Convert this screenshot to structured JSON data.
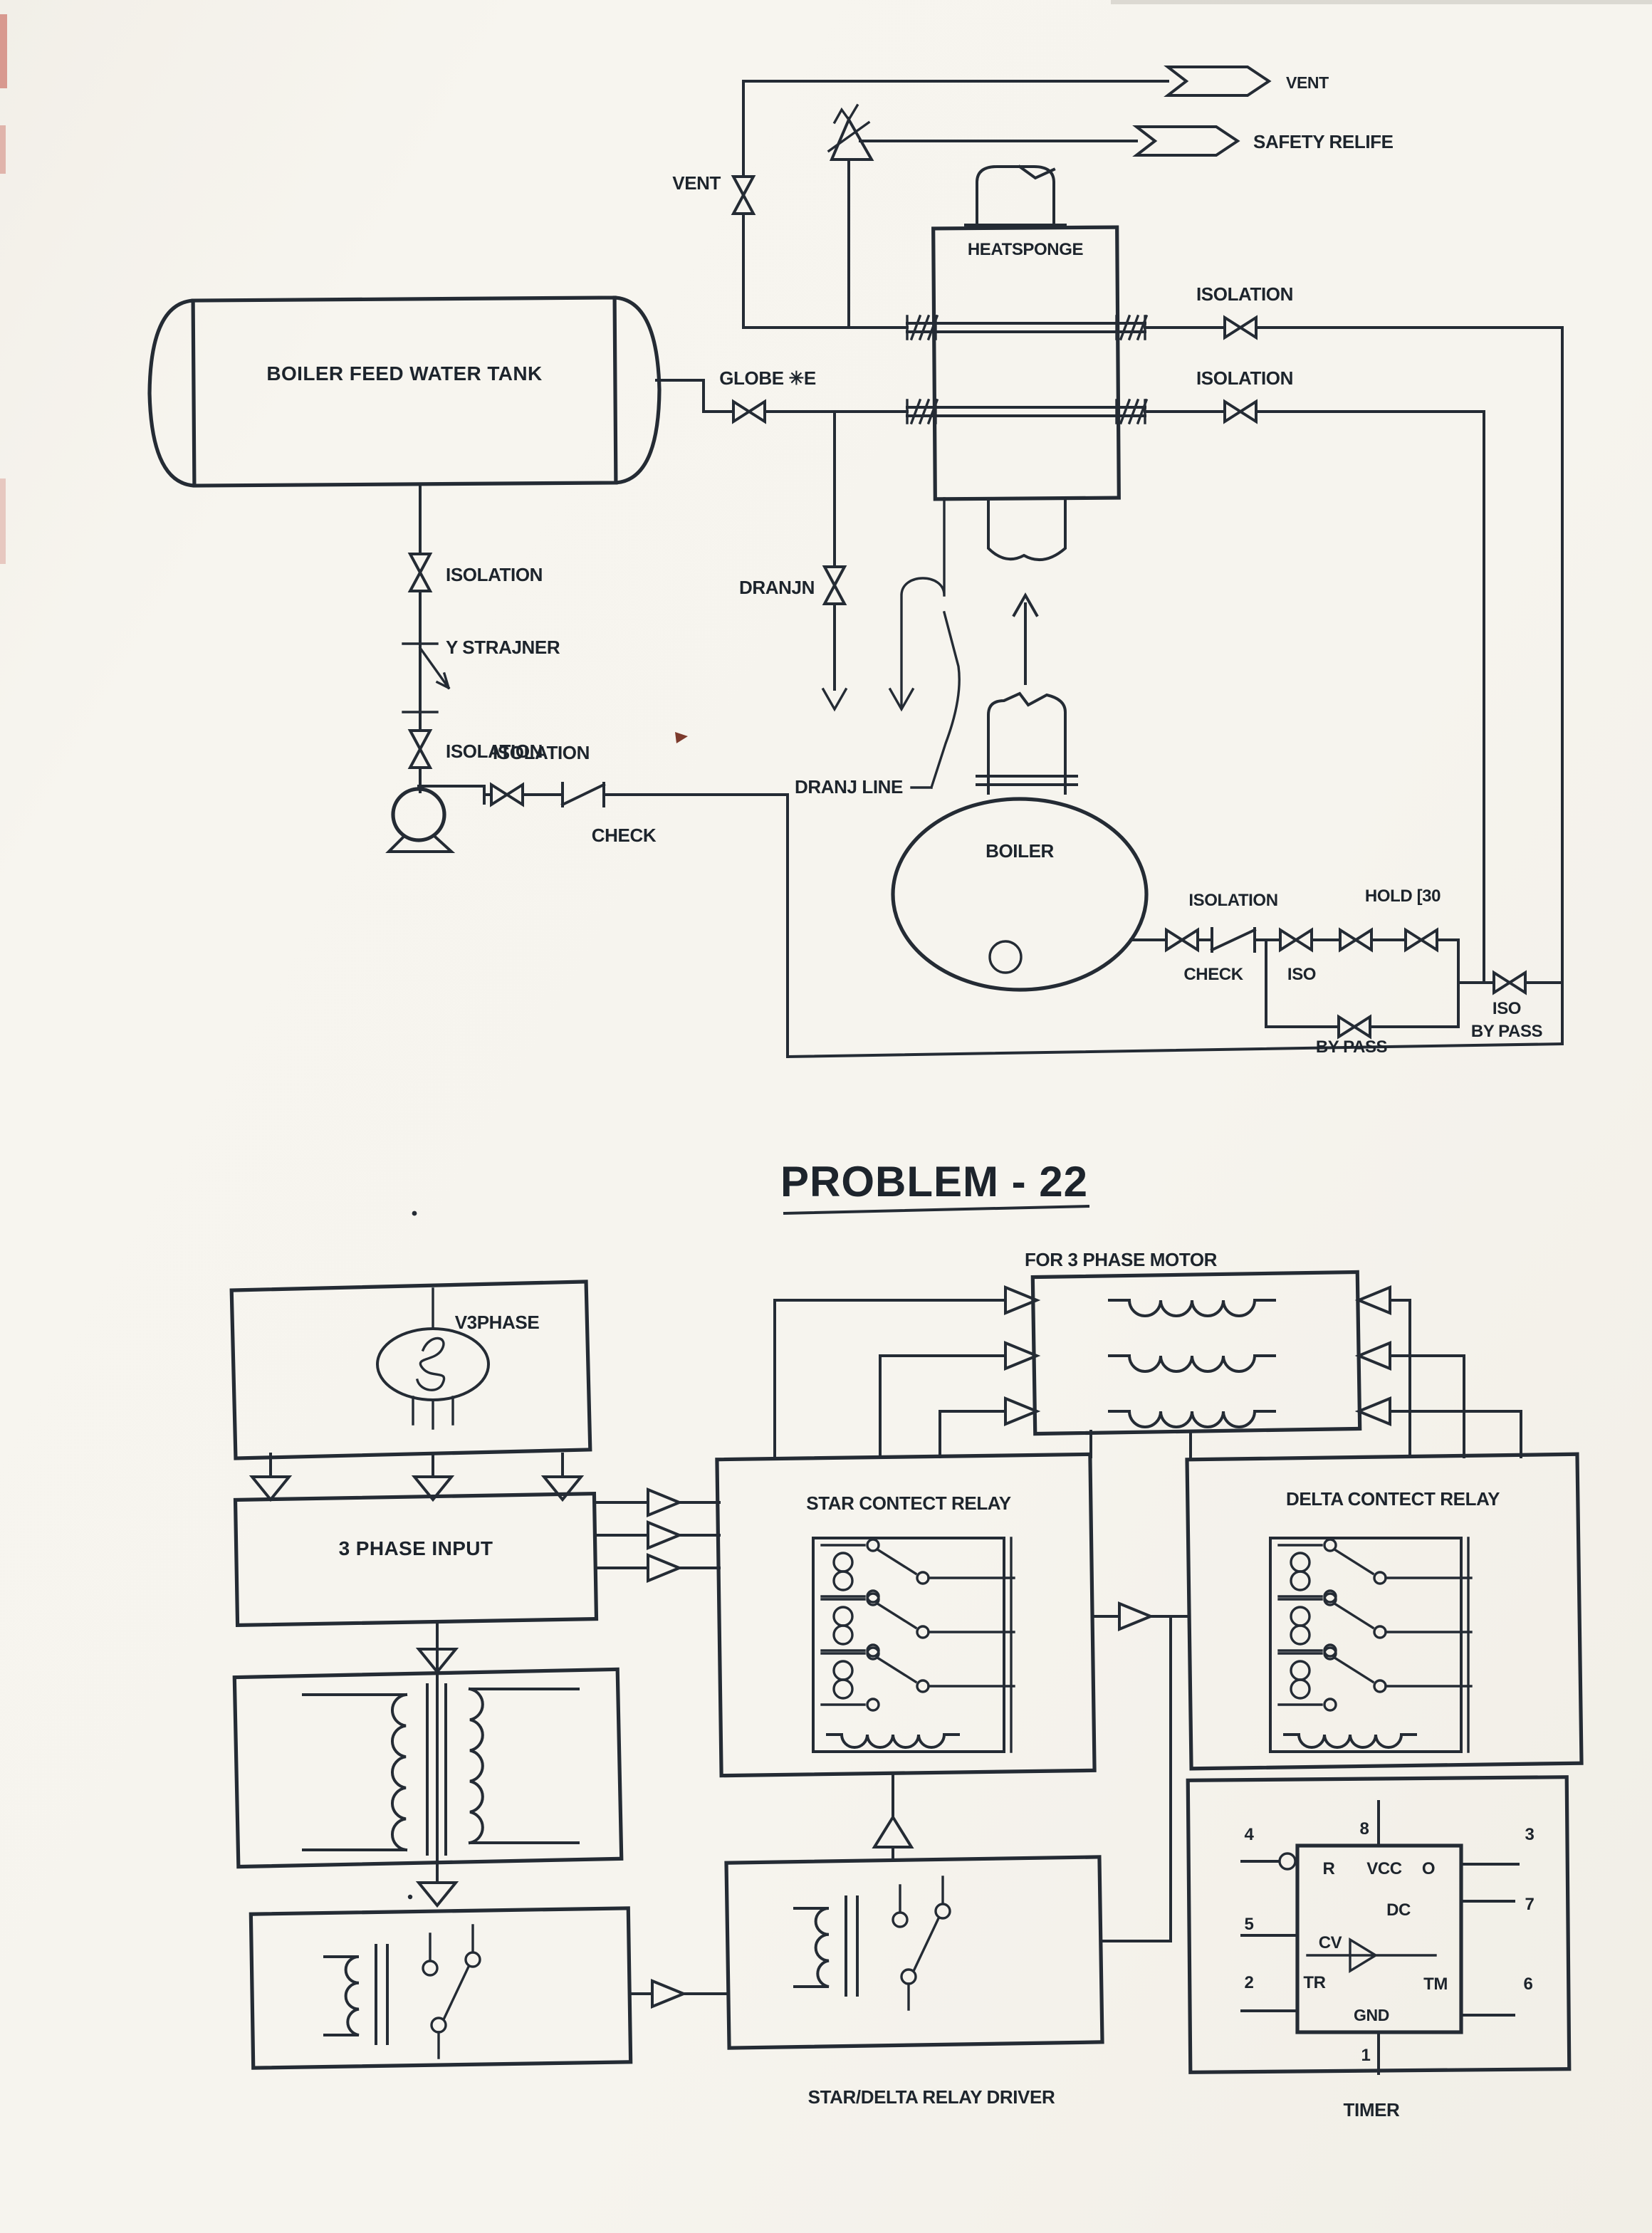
{
  "colors": {
    "ink": "#242b34",
    "paper": "#f6f4ee",
    "speck": "#7c3a2c",
    "edge_mark": "#c96a5f"
  },
  "pid": {
    "vent_header": "VENT",
    "safety_relief": "SAFETY RELIFE",
    "vent_valve": "VENT",
    "heatsponge": "HEATSPONGE",
    "hs_isolation_top": "ISOLATION",
    "hs_isolation_bottom": "ISOLATION",
    "globe": "GLOBE ✳E",
    "tank": "BOILER FEED WATER TANK",
    "feed_isolation_1": "ISOLATION",
    "y_strainer": "Y STRAJNER",
    "feed_isolation_2": "ISOLATION",
    "pump_isolation": "ISOLATION",
    "pump_check": "CHECK",
    "dranjn": "DRANJN",
    "dranj_line": "DRANJ LINE",
    "boiler": "BOILER",
    "outlet_isolation": "ISOLATION",
    "outlet_check": "CHECK",
    "outlet_iso": "ISO",
    "outlet_hold": "HOLD [30",
    "bypass": "BY PASS",
    "iso_bypass_iso": "ISO",
    "iso_bypass_bypass": "BY PASS"
  },
  "problem": {
    "title": "PROBLEM - 22"
  },
  "motor": {
    "heading": "FOR 3 PHASE MOTOR",
    "v3phase": "V3PHASE",
    "phase_input": "3 PHASE INPUT",
    "star_relay": "STAR CONTECT RELAY",
    "delta_relay": "DELTA CONTECT RELAY",
    "driver": "STAR/DELTA RELAY DRIVER",
    "timer": "TIMER",
    "pins": {
      "p1": "1",
      "p2": "2",
      "p3": "3",
      "p4": "4",
      "p5": "5",
      "p6": "6",
      "p7": "7",
      "p8": "8"
    },
    "ic": {
      "r": "R",
      "vcc": "VCC",
      "o": "O",
      "dc": "DC",
      "cv": "CV",
      "tr": "TR",
      "tm": "TM",
      "gnd": "GND"
    }
  }
}
